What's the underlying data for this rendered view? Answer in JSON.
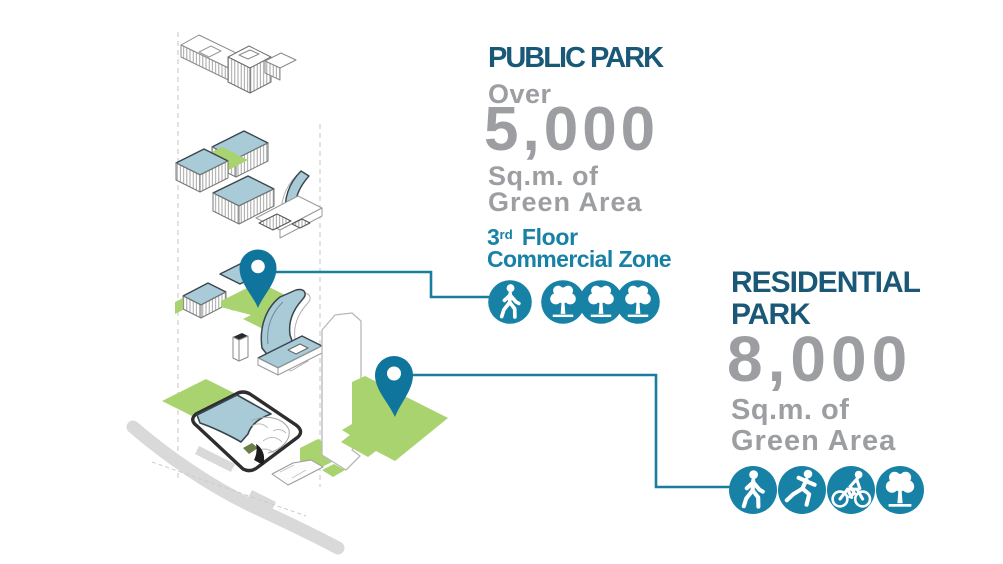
{
  "public_park": {
    "title": "PUBLIC PARK",
    "qualifier": "Over",
    "area_value": "5,000",
    "area_unit": "Sq.m. of",
    "area_label": "Green Area",
    "floor_number": "3",
    "floor_ordinal": "rd",
    "floor_word": "Floor",
    "zone_label": "Commercial Zone",
    "icons": [
      "pedestrian-icon",
      "tree-icon",
      "tree-icon",
      "tree-icon"
    ]
  },
  "residential_park": {
    "title_line1": "RESIDENTIAL",
    "title_line2": "PARK",
    "area_value": "8,000",
    "area_unit": "Sq.m. of",
    "area_label": "Green Area",
    "icons": [
      "pedestrian-icon",
      "runner-icon",
      "cyclist-icon",
      "tree-icon"
    ]
  },
  "diagram": {
    "description": "Exploded isometric site diagram: stacked floor plates with green terraces, curved building volumes, ground-level site plan with roads and a high-rise tower outline",
    "markers": [
      {
        "name": "public-park-pin",
        "links_to": "public_park"
      },
      {
        "name": "residential-park-pin",
        "links_to": "residential_park"
      }
    ]
  },
  "colors": {
    "heading": "#1a5878",
    "muted_gray": "#9c9ea1",
    "teal": "#1781a6",
    "pin_teal": "#0f759c",
    "connector": "#1a7c9e",
    "green_area": "#a8d36e",
    "roof_blue": "#a9cbd8",
    "road_gray": "#d9d9d9"
  }
}
